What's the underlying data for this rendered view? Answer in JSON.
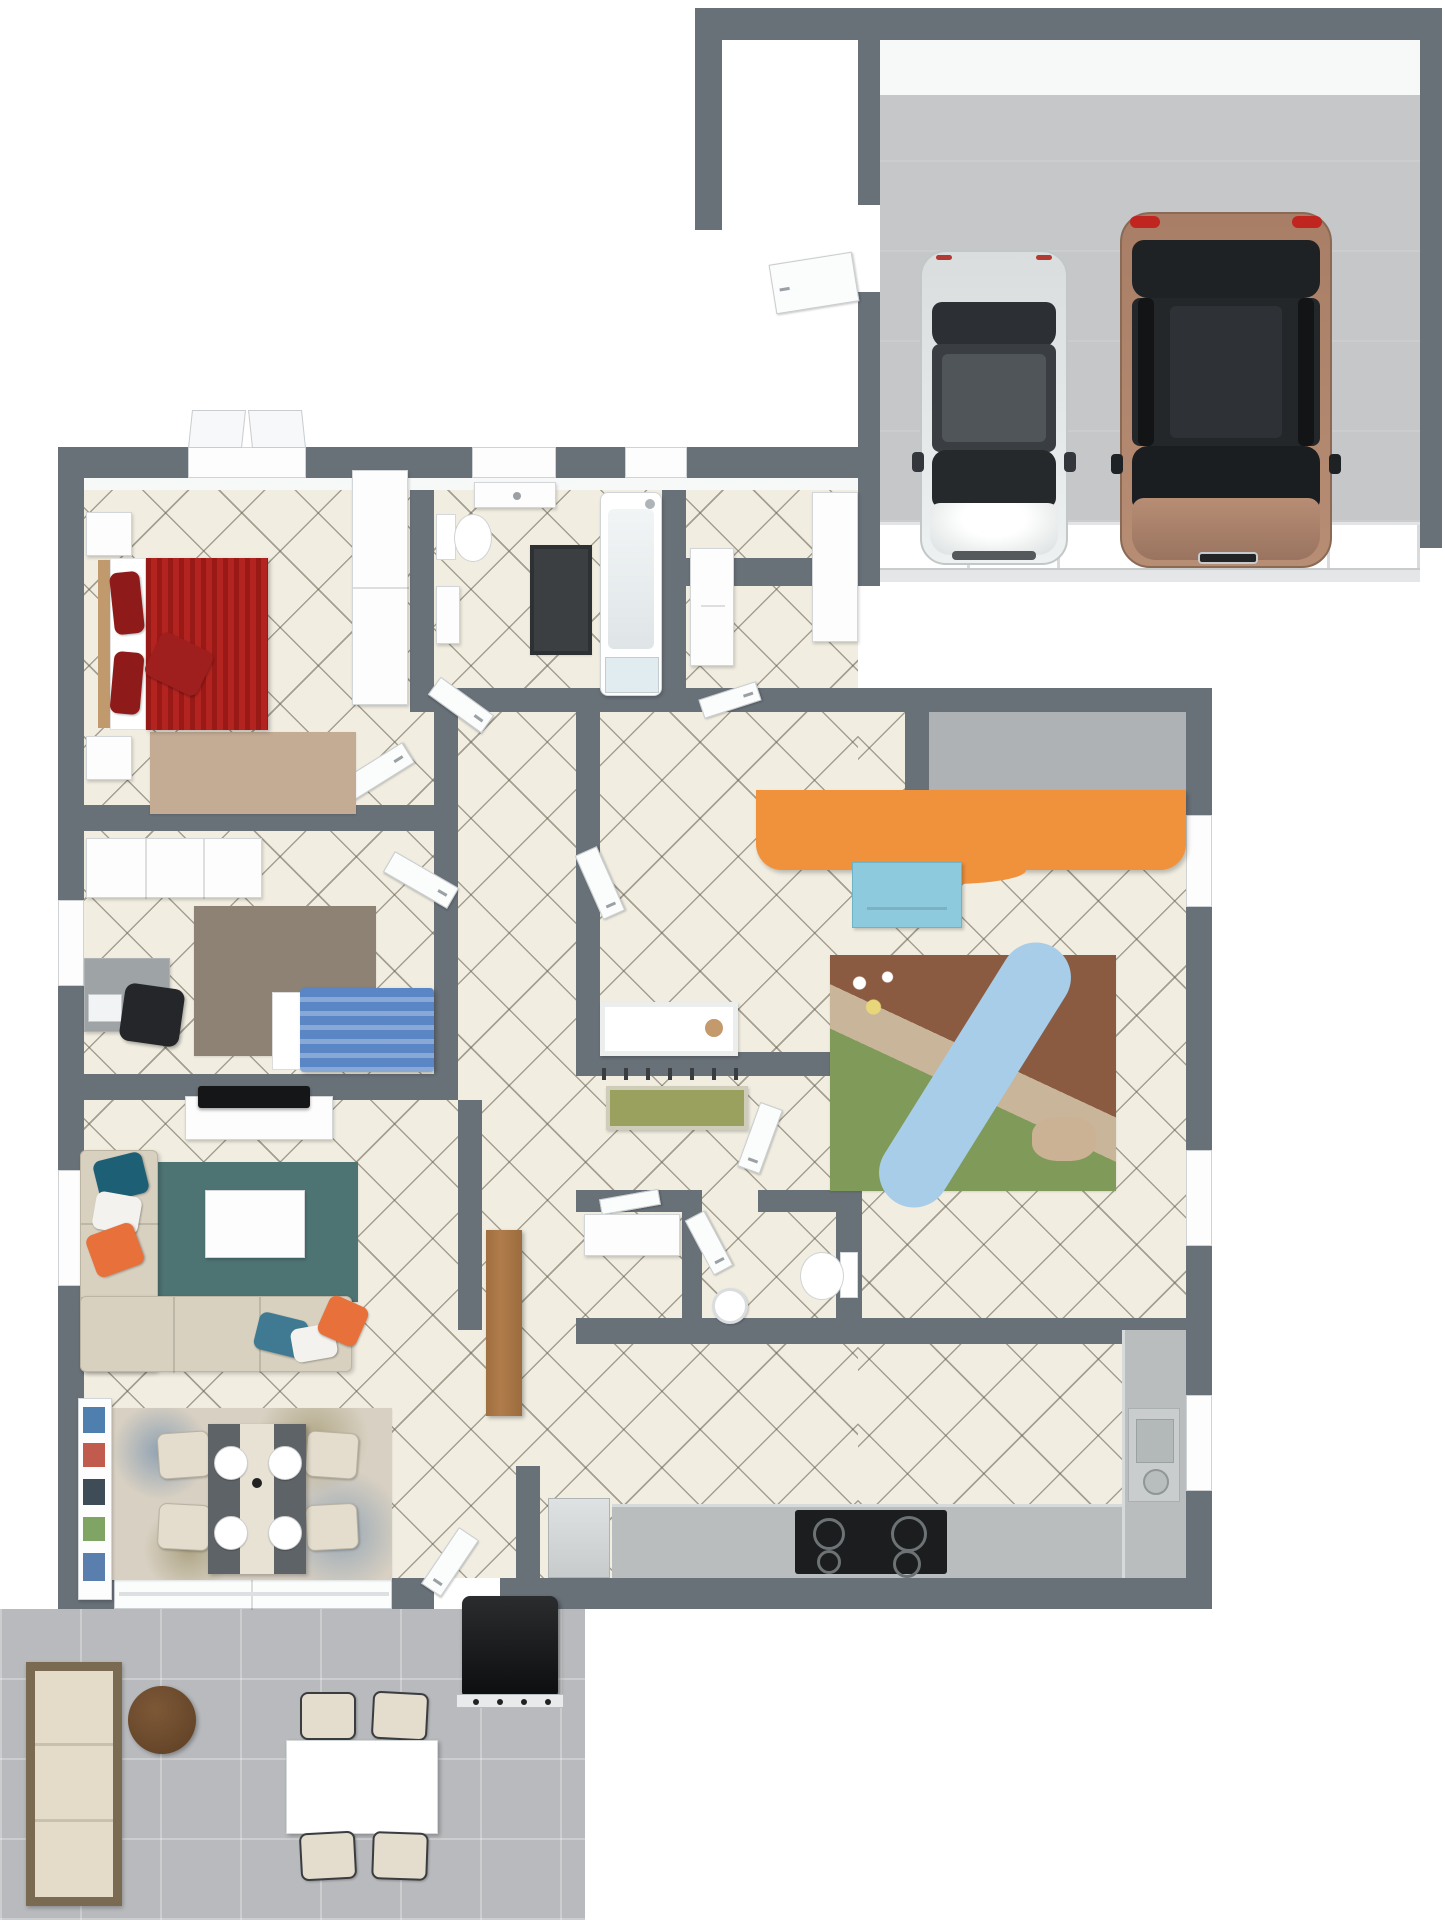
{
  "document": {
    "title": "3D floor plan render — single-story house with double garage and patio"
  },
  "colors": {
    "wall": "#687078",
    "tile_floor": "#f1ede1",
    "tile_line": "#64604e",
    "garage_floor": "#c6c7c9",
    "patio_floor": "#b8babd",
    "bed_red": "#b32420",
    "bed_blue": "#5b86c6",
    "sofa_cream": "#d8d1c0",
    "rug_teal": "#4d7473",
    "rug_beige": "#c3ab94",
    "rug_graybrown": "#8e8274",
    "desk_orange": "#f0913c",
    "drawer_blue": "#8ecadd",
    "bench_olive": "#9aa05e",
    "car_silver": "#dfe3e3",
    "car_bronze": "#ab8169",
    "wood_console": "#b07c4a",
    "wood_table_dark": "#6d4b2f",
    "counter_gray": "#b9bdbd",
    "bathmat_dark": "#3c3f42"
  },
  "scene": {
    "type": "3d-floor-plan-top-view",
    "rooms": [
      {
        "id": "garage",
        "name": "garage",
        "items": [
          "silver-sedan",
          "bronze-suv",
          "sectional-garage-door",
          "side-entry-door"
        ]
      },
      {
        "id": "bedroom-master",
        "name": "master bedroom",
        "items": [
          "red-double-bed",
          "nightstand-left",
          "nightstand-right",
          "beige-rug",
          "tall-wardrobe",
          "casement-window"
        ]
      },
      {
        "id": "bathroom",
        "name": "bathroom",
        "items": [
          "toilet",
          "wall-cabinet",
          "dark-bath-mat",
          "bathtub-with-shower",
          "washbasin-vanity",
          "window"
        ]
      },
      {
        "id": "laundry",
        "name": "laundry / utility room",
        "items": [
          "washing-machine",
          "counter",
          "window"
        ]
      },
      {
        "id": "bedroom-second",
        "name": "second bedroom / office",
        "items": [
          "wardrobe-row",
          "desk",
          "office-chair",
          "laptop",
          "gray-brown-rug",
          "blue-single-bed",
          "window"
        ]
      },
      {
        "id": "kids-room",
        "name": "kids room / nursery",
        "items": [
          "orange-wavy-desk",
          "blue-drawer-stool",
          "landscape-play-rug",
          "white-crib",
          "teddy-bear",
          "storage-niche",
          "window"
        ]
      },
      {
        "id": "living-room",
        "name": "living room",
        "items": [
          "tv-sideboard",
          "flat-tv",
          "l-shaped-cream-sofa",
          "teal-pillows",
          "orange-pillows",
          "white-pillows",
          "teal-rug",
          "white-coffee-table",
          "windows"
        ]
      },
      {
        "id": "dining-area",
        "name": "dining area",
        "items": [
          "floral-rug",
          "dining-table",
          "four-cream-chairs",
          "place-settings",
          "bookshelf",
          "sliding-glass-door"
        ]
      },
      {
        "id": "hallway",
        "name": "hallway / entry",
        "items": [
          "wooden-console",
          "coat-hooks",
          "olive-bench"
        ]
      },
      {
        "id": "wc",
        "name": "guest WC",
        "items": [
          "toilet",
          "round-washbasin"
        ]
      },
      {
        "id": "closet",
        "name": "storage closet",
        "items": [
          "white-shelf"
        ]
      },
      {
        "id": "kitchen",
        "name": "kitchen",
        "items": [
          "bottom-counter",
          "right-counter",
          "black-cooktop",
          "stainless-sink-with-pot",
          "dishwasher"
        ]
      }
    ],
    "outdoor": {
      "id": "patio",
      "name": "patio / terrace",
      "items": [
        "outdoor-wicker-sofa",
        "round-wood-coffee-table",
        "outdoor-dining-table",
        "four-sling-chairs",
        "black-grill"
      ]
    },
    "garage_cars": [
      {
        "id": "car-silver-sedan",
        "body_color": "#dfe3e3"
      },
      {
        "id": "car-bronze-suv",
        "body_color": "#ab8169"
      }
    ]
  }
}
